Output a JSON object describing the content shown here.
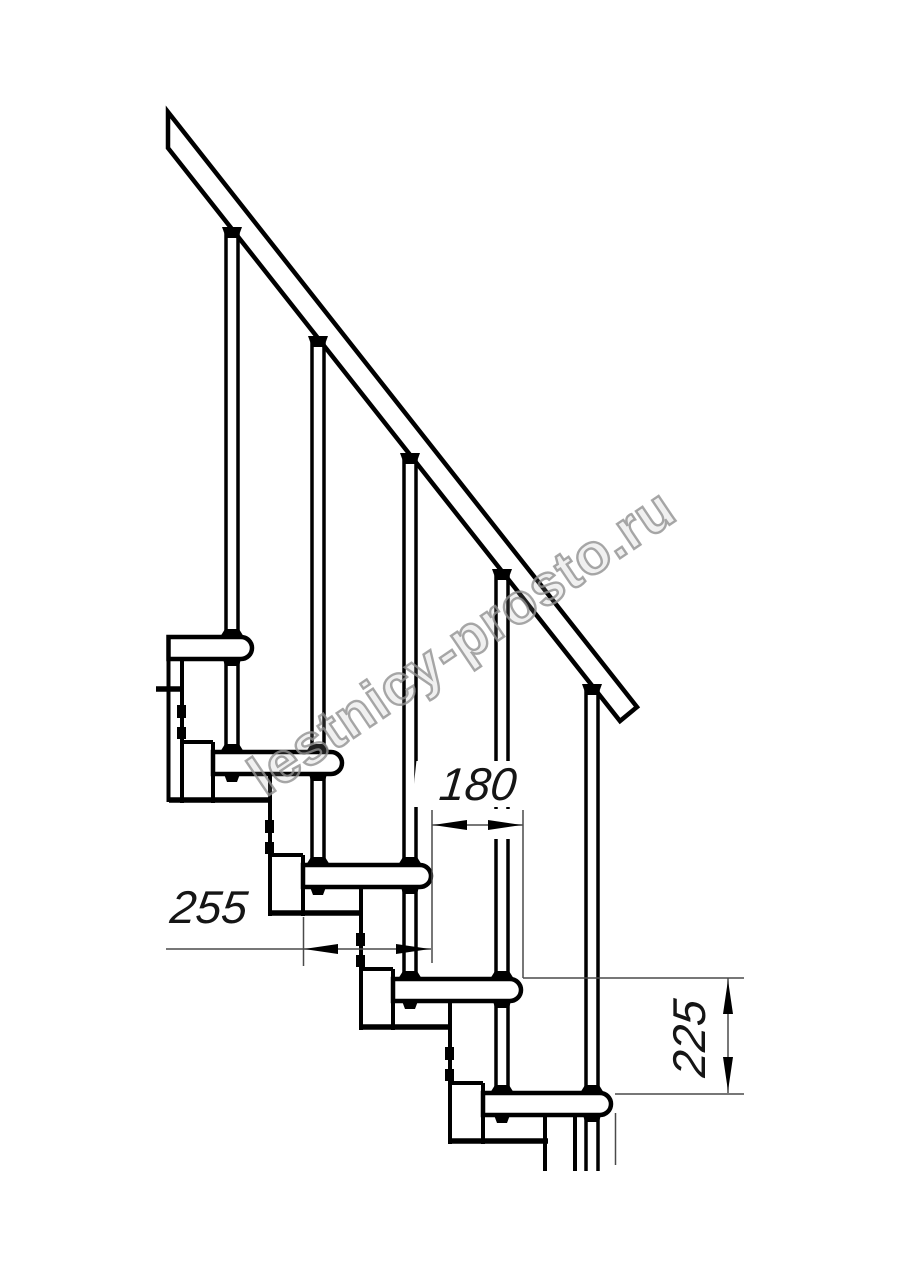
{
  "page": {
    "width": 914,
    "height": 1280,
    "background": "#ffffff",
    "ink_color": "#000000",
    "thin_line_color": "#4a4a4a",
    "title": "Staircase side elevation drawing"
  },
  "watermark": {
    "text": "lestnicy-prosto.ru",
    "color": "#919191"
  },
  "dimensions": {
    "run": {
      "label": "180",
      "orientation": "horizontal"
    },
    "depth": {
      "label": "255",
      "orientation": "horizontal"
    },
    "rise": {
      "label": "225",
      "orientation": "vertical"
    }
  },
  "drawing": {
    "tread_thickness": 22,
    "tread_nose_radius": 11,
    "stroke_main": 4.5,
    "stroke_module": 4,
    "stroke_tube": 3.5,
    "stroke_plate": 5.5,
    "stroke_thin": 1.5,
    "treads": [
      [
        168.5,
        637,
        252
      ],
      [
        213,
        752,
        342
      ],
      [
        303,
        865,
        431
      ],
      [
        393,
        979,
        521
      ],
      [
        483,
        1093,
        611
      ]
    ],
    "rail_points": [
      [
        168,
        112
      ],
      [
        168,
        148
      ],
      [
        620,
        721
      ],
      [
        637,
        707
      ]
    ],
    "tubes_upper": [
      [
        232,
        233,
        637
      ],
      [
        318,
        342,
        752
      ],
      [
        410,
        459,
        865
      ],
      [
        502,
        575,
        979
      ],
      [
        592,
        690,
        1093
      ]
    ],
    "tubes_lower": [
      [
        232,
        659,
        752
      ],
      [
        318,
        774,
        865
      ],
      [
        410,
        887,
        979
      ],
      [
        502,
        1001,
        1093
      ],
      [
        592,
        1115,
        1171
      ]
    ],
    "tube_half_gap": 6,
    "rail_wedges": [
      [
        232,
        229
      ],
      [
        318,
        338
      ],
      [
        410,
        455
      ],
      [
        502,
        571
      ],
      [
        592,
        686
      ]
    ],
    "feet": [
      [
        232,
        637
      ],
      [
        232,
        752
      ],
      [
        318,
        752
      ],
      [
        318,
        865
      ],
      [
        410,
        865
      ],
      [
        410,
        979
      ],
      [
        502,
        979
      ],
      [
        502,
        1093
      ],
      [
        592,
        1093
      ]
    ],
    "tube_caps": [
      [
        232,
        659
      ],
      [
        318,
        774
      ],
      [
        410,
        887
      ],
      [
        502,
        1001
      ],
      [
        592,
        1115
      ]
    ],
    "nubs": [
      [
        232,
        774
      ],
      [
        318,
        887
      ],
      [
        410,
        1001
      ],
      [
        502,
        1115
      ]
    ],
    "modules": [
      {
        "xL": 182,
        "xR": 213,
        "top": 659,
        "div": 742,
        "plate": 800,
        "px1": 169,
        "px2": 272
      },
      {
        "xL": 270,
        "xR": 303,
        "top": 774,
        "div": 855,
        "plate": 913,
        "px1": 270,
        "px2": 363
      },
      {
        "xL": 361,
        "xR": 393,
        "top": 887,
        "div": 969,
        "plate": 1027,
        "px1": 361,
        "px2": 452
      },
      {
        "xL": 450,
        "xR": 483,
        "top": 1001,
        "div": 1083,
        "plate": 1141,
        "px1": 450,
        "px2": 548
      }
    ],
    "extra_lines": [
      [
        168.5,
        659,
        168.5,
        802,
        4
      ],
      [
        156,
        689,
        183,
        689,
        5.5
      ],
      [
        545,
        1115,
        545,
        1171,
        4
      ],
      [
        575,
        1115,
        575,
        1171,
        4
      ]
    ],
    "masks": [
      [
        448,
        809,
        68,
        30
      ]
    ],
    "extension_lines": [
      [
        432,
        810,
        432,
        963
      ],
      [
        523,
        810,
        523,
        978
      ],
      [
        303.5,
        917,
        303.5,
        966
      ],
      [
        523,
        978,
        744,
        978
      ],
      [
        615,
        1094,
        744,
        1094
      ],
      [
        615.5,
        1113,
        615.5,
        1165
      ]
    ],
    "dimension_lines": [
      [
        166,
        949,
        431,
        949
      ],
      [
        432,
        825,
        523,
        825
      ],
      [
        728,
        978,
        728,
        1093
      ]
    ],
    "arrows": [
      {
        "tip": [
          304,
          949
        ],
        "dir": "left"
      },
      {
        "tip": [
          430,
          949
        ],
        "dir": "right"
      },
      {
        "tip": [
          433,
          825
        ],
        "dir": "left"
      },
      {
        "tip": [
          522,
          825
        ],
        "dir": "right"
      },
      {
        "tip": [
          728,
          980
        ],
        "dir": "up"
      },
      {
        "tip": [
          728,
          1091
        ],
        "dir": "down"
      }
    ],
    "arrow_length": 34,
    "arrow_half_width": 5
  }
}
